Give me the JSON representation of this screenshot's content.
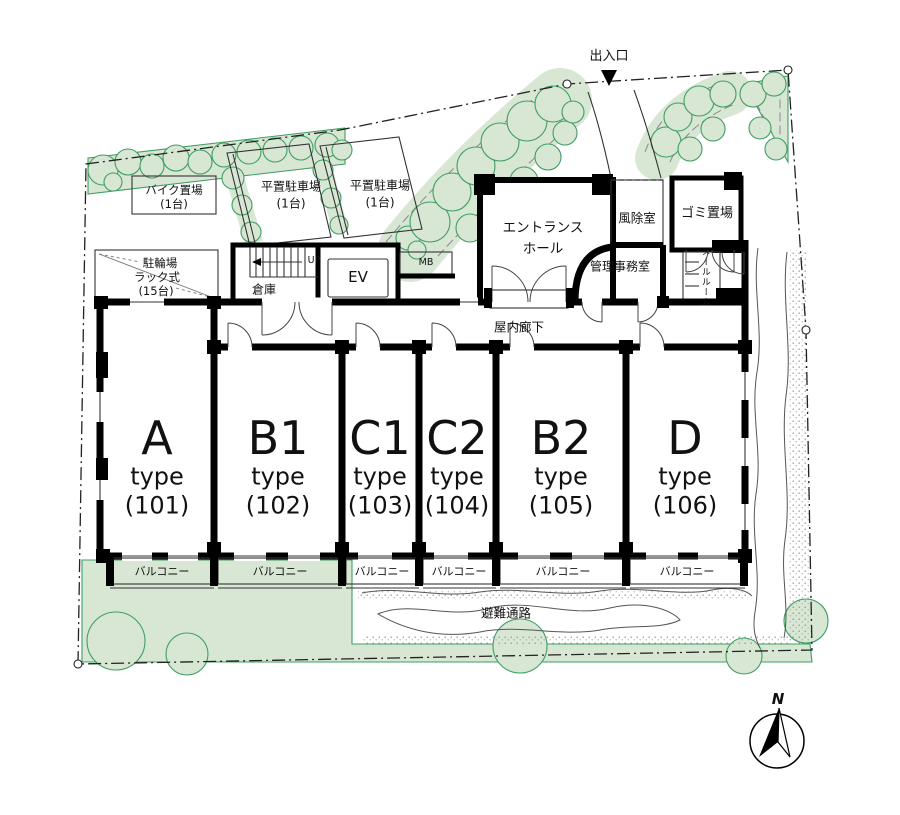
{
  "site": {
    "entrance_label": "出入口",
    "corridor_label": "屋内廊下",
    "evacuation_label": "避難通路",
    "balcony_label": "バルコニー",
    "compass_label": "N"
  },
  "facilities": {
    "bike_storage_line1": "バイク置場",
    "bike_storage_line2": "(1台)",
    "parking_left_line1": "平置駐車場",
    "parking_left_line2": "(1台)",
    "parking_right_line1": "平置駐車場",
    "parking_right_line2": "(1台)",
    "bicycle_parking_line1": "駐輪場",
    "bicycle_parking_line2": "ラック式",
    "bicycle_parking_line3": "(15台)",
    "storage": "倉庫",
    "stairs_up": "UP",
    "elevator": "EV",
    "mailbox": "MB",
    "entrance_hall_line1": "エントランス",
    "entrance_hall_line2": "ホール",
    "windbreak_room": "風除室",
    "garbage_area": "ゴミ置場",
    "management_office": "管理事務室",
    "mail_room": "メールルーム"
  },
  "units": [
    {
      "name": "A",
      "type_label": "type",
      "number": "(101)"
    },
    {
      "name": "B1",
      "type_label": "type",
      "number": "(102)"
    },
    {
      "name": "C1",
      "type_label": "type",
      "number": "(103)"
    },
    {
      "name": "C2",
      "type_label": "type",
      "number": "(104)"
    },
    {
      "name": "B2",
      "type_label": "type",
      "number": "(105)"
    },
    {
      "name": "D",
      "type_label": "type",
      "number": "(106)"
    }
  ],
  "colors": {
    "tree_fill": "#d8e6d4",
    "tree_stroke": "#3f9e63",
    "wall": "#000000",
    "stipple": "#8a8a8a"
  }
}
